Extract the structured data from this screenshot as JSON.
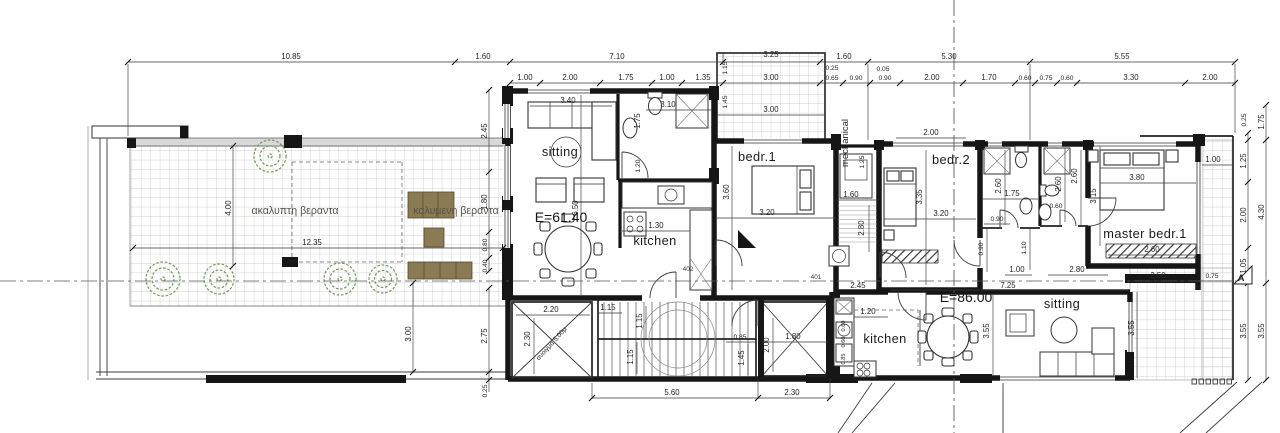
{
  "drawing": {
    "type": "architectural floor plan",
    "apartments": [
      {
        "name": "unit-1",
        "area_label": "E=61.40",
        "rooms": [
          "sitting",
          "kitchen",
          "bedr.1"
        ],
        "room_number": "402"
      },
      {
        "name": "unit-2",
        "area_label": "E=86.00",
        "rooms": [
          "sitting",
          "kitchen",
          "bedr.2",
          "master bedr.1"
        ],
        "room_number": "401"
      }
    ],
    "outdoor": {
      "uncovered_veranda": "ακαλυπτη βεραντα",
      "covered_veranda": "καλυμενη βεραντα"
    },
    "service_spaces": [
      "mechanical"
    ],
    "opening_note": "ανοιγμα 5.00μ",
    "section_marker": "A"
  },
  "colors": {
    "paper": "#ffffff",
    "wall": "#161616",
    "tile_line": "#c4c4c4",
    "tree": "#6d9c50",
    "wood_furniture": "#8b7b54",
    "dim_text": "#262626"
  },
  "plan": {
    "labels": [
      {
        "t": "10.85",
        "x": 291,
        "y": 59,
        "k": "dim"
      },
      {
        "t": "1.60",
        "x": 483,
        "y": 59,
        "k": "dim"
      },
      {
        "t": "7.10",
        "x": 617,
        "y": 59,
        "k": "dim"
      },
      {
        "t": "3.25",
        "x": 771,
        "y": 57,
        "k": "dim"
      },
      {
        "t": "1.60",
        "x": 844,
        "y": 59,
        "k": "dim"
      },
      {
        "t": "5.30",
        "x": 949,
        "y": 59,
        "k": "dim"
      },
      {
        "t": "5.55",
        "x": 1122,
        "y": 59,
        "k": "dim"
      },
      {
        "t": "0.25",
        "x": 832,
        "y": 70,
        "k": "tiny"
      },
      {
        "t": "0.05",
        "x": 883,
        "y": 71,
        "k": "tiny"
      },
      {
        "t": "1.00",
        "x": 525,
        "y": 80,
        "k": "dim"
      },
      {
        "t": "2.00",
        "x": 570,
        "y": 80,
        "k": "dim"
      },
      {
        "t": "1.75",
        "x": 626,
        "y": 80,
        "k": "dim"
      },
      {
        "t": "1.00",
        "x": 667,
        "y": 80,
        "k": "dim"
      },
      {
        "t": "1.35",
        "x": 703,
        "y": 80,
        "k": "dim"
      },
      {
        "t": "3.00",
        "x": 771,
        "y": 80,
        "k": "dim"
      },
      {
        "t": "0.65",
        "x": 832,
        "y": 80,
        "k": "tiny"
      },
      {
        "t": "0.90",
        "x": 856,
        "y": 80,
        "k": "tiny"
      },
      {
        "t": "0.90",
        "x": 885,
        "y": 80,
        "k": "tiny"
      },
      {
        "t": "2.00",
        "x": 932,
        "y": 80,
        "k": "dim"
      },
      {
        "t": "1.70",
        "x": 989,
        "y": 80,
        "k": "dim"
      },
      {
        "t": "0.60",
        "x": 1025,
        "y": 80,
        "k": "tiny"
      },
      {
        "t": "0.75",
        "x": 1046,
        "y": 80,
        "k": "tiny"
      },
      {
        "t": "0.60",
        "x": 1067,
        "y": 80,
        "k": "tiny"
      },
      {
        "t": "3.30",
        "x": 1131,
        "y": 80,
        "k": "dim"
      },
      {
        "t": "2.00",
        "x": 1210,
        "y": 80,
        "k": "dim"
      },
      {
        "t": "0.25",
        "x": 1246,
        "y": 120,
        "r": -90,
        "k": "tiny"
      },
      {
        "t": "1.75",
        "x": 1264,
        "y": 122,
        "r": -90,
        "k": "dim"
      },
      {
        "t": "1.25",
        "x": 1246,
        "y": 161,
        "r": -90,
        "k": "dim"
      },
      {
        "t": "2.00",
        "x": 1246,
        "y": 215,
        "r": -90,
        "k": "dim"
      },
      {
        "t": "4.30",
        "x": 1264,
        "y": 212,
        "r": -90,
        "k": "dim"
      },
      {
        "t": "1.05",
        "x": 1246,
        "y": 266,
        "r": -90,
        "k": "dim"
      },
      {
        "t": "3.55",
        "x": 1246,
        "y": 331,
        "r": -90,
        "k": "dim"
      },
      {
        "t": "3.55",
        "x": 1264,
        "y": 331,
        "r": -90,
        "k": "dim"
      },
      {
        "t": "2.45",
        "x": 487,
        "y": 131,
        "r": -90,
        "k": "dim"
      },
      {
        "t": "1.80",
        "x": 487,
        "y": 202,
        "r": -90,
        "k": "dim"
      },
      {
        "t": "0.80",
        "x": 487,
        "y": 245,
        "r": -90,
        "k": "tiny"
      },
      {
        "t": "0.40",
        "x": 487,
        "y": 266,
        "r": -90,
        "k": "tiny"
      },
      {
        "t": "2.75",
        "x": 487,
        "y": 336,
        "r": -90,
        "k": "dim"
      },
      {
        "t": "0.25",
        "x": 487,
        "y": 391,
        "r": -90,
        "k": "tiny"
      },
      {
        "t": "3.00",
        "x": 411,
        "y": 334,
        "r": -90,
        "k": "dim"
      },
      {
        "t": "4.00",
        "x": 231,
        "y": 208,
        "r": -90,
        "k": "dim"
      },
      {
        "t": "12.35",
        "x": 312,
        "y": 245,
        "k": "dim"
      },
      {
        "t": "5.60",
        "x": 672,
        "y": 395,
        "k": "dim"
      },
      {
        "t": "2.30",
        "x": 792,
        "y": 395,
        "k": "dim"
      },
      {
        "t": "sitting",
        "x": 560,
        "y": 156,
        "k": "room"
      },
      {
        "t": "E=61.40",
        "x": 561,
        "y": 222,
        "k": "area"
      },
      {
        "t": "kitchen",
        "x": 655,
        "y": 245,
        "k": "room"
      },
      {
        "t": "3.40",
        "x": 568,
        "y": 103,
        "k": "dim"
      },
      {
        "t": "3.10",
        "x": 668,
        "y": 107,
        "k": "dim"
      },
      {
        "t": "1.75",
        "x": 640,
        "y": 121,
        "r": -90,
        "k": "dim"
      },
      {
        "t": "1.20",
        "x": 640,
        "y": 166,
        "r": -90,
        "k": "tiny"
      },
      {
        "t": "6.50",
        "x": 578,
        "y": 208,
        "r": -90,
        "k": "dim"
      },
      {
        "t": "1.30",
        "x": 656,
        "y": 228,
        "k": "dim"
      },
      {
        "t": "402",
        "x": 688,
        "y": 271,
        "k": "num"
      },
      {
        "t": "bedr.1",
        "x": 757,
        "y": 161,
        "k": "room"
      },
      {
        "t": "3.60",
        "x": 729,
        "y": 192,
        "r": -90,
        "k": "dim"
      },
      {
        "t": "3.20",
        "x": 767,
        "y": 215,
        "k": "dim"
      },
      {
        "t": "3.00",
        "x": 771,
        "y": 112,
        "k": "dim"
      },
      {
        "t": "1.15",
        "x": 727,
        "y": 68,
        "r": -90,
        "k": "tiny"
      },
      {
        "t": "1.45",
        "x": 727,
        "y": 102,
        "r": -90,
        "k": "tiny"
      },
      {
        "t": "mechanical",
        "x": 848,
        "y": 143,
        "r": -90,
        "k": "roomv"
      },
      {
        "t": "1.25",
        "x": 864,
        "y": 162,
        "r": -90,
        "k": "tiny"
      },
      {
        "t": "1.60",
        "x": 851,
        "y": 197,
        "k": "dim"
      },
      {
        "t": "2.80",
        "x": 864,
        "y": 228,
        "r": -90,
        "k": "dim"
      },
      {
        "t": "401",
        "x": 816,
        "y": 279,
        "k": "num"
      },
      {
        "t": "2.45",
        "x": 858,
        "y": 288,
        "k": "dim"
      },
      {
        "t": "bedr.2",
        "x": 951,
        "y": 164,
        "k": "room"
      },
      {
        "t": "2.00",
        "x": 931,
        "y": 135,
        "k": "dim"
      },
      {
        "t": "3.35",
        "x": 922,
        "y": 197,
        "r": -90,
        "k": "dim"
      },
      {
        "t": "3.20",
        "x": 941,
        "y": 216,
        "k": "dim"
      },
      {
        "t": "2.60",
        "x": 1001,
        "y": 186,
        "r": -90,
        "k": "dim"
      },
      {
        "t": "1.75",
        "x": 1012,
        "y": 196,
        "k": "dim"
      },
      {
        "t": "2.60",
        "x": 1061,
        "y": 184,
        "r": -90,
        "k": "dim"
      },
      {
        "t": "0.60",
        "x": 1056,
        "y": 208,
        "k": "tiny"
      },
      {
        "t": "0.90",
        "x": 997,
        "y": 221,
        "k": "tiny"
      },
      {
        "t": "0.90",
        "x": 983,
        "y": 249,
        "r": -90,
        "k": "tiny"
      },
      {
        "t": "1.10",
        "x": 1026,
        "y": 248,
        "r": -90,
        "k": "tiny"
      },
      {
        "t": "1.00",
        "x": 1017,
        "y": 272,
        "k": "dim"
      },
      {
        "t": "2.80",
        "x": 1077,
        "y": 272,
        "k": "dim"
      },
      {
        "t": "master  bedr.1",
        "x": 1145,
        "y": 238,
        "k": "room"
      },
      {
        "t": "2.60",
        "x": 1077,
        "y": 176,
        "r": -90,
        "k": "dim"
      },
      {
        "t": "3.15",
        "x": 1096,
        "y": 196,
        "r": -90,
        "k": "dim"
      },
      {
        "t": "3.80",
        "x": 1137,
        "y": 180,
        "k": "dim"
      },
      {
        "t": "2.60",
        "x": 1152,
        "y": 252,
        "k": "dim"
      },
      {
        "t": "1.00",
        "x": 1213,
        "y": 162,
        "k": "dim"
      },
      {
        "t": "2.50",
        "x": 1158,
        "y": 278,
        "k": "dim"
      },
      {
        "t": "0.75",
        "x": 1212,
        "y": 278,
        "k": "tiny"
      },
      {
        "t": "2.20",
        "x": 551,
        "y": 312,
        "k": "dim"
      },
      {
        "t": "2.30",
        "x": 530,
        "y": 339,
        "r": -90,
        "k": "dim"
      },
      {
        "t": "ανοιγμα 5.00μ",
        "x": 553,
        "y": 345,
        "r": -48,
        "k": "tiny"
      },
      {
        "t": "1.15",
        "x": 608,
        "y": 310,
        "k": "dim"
      },
      {
        "t": "1.15",
        "x": 642,
        "y": 321,
        "r": -90,
        "k": "dim"
      },
      {
        "t": "1.15",
        "x": 633,
        "y": 357,
        "r": -90,
        "k": "dim"
      },
      {
        "t": "0.85",
        "x": 740,
        "y": 339,
        "k": "tiny"
      },
      {
        "t": "1.45",
        "x": 744,
        "y": 358,
        "r": -90,
        "k": "dim"
      },
      {
        "t": "2.00",
        "x": 769,
        "y": 345,
        "r": -90,
        "k": "dim"
      },
      {
        "t": "1.80",
        "x": 793,
        "y": 339,
        "k": "dim"
      },
      {
        "t": "E=86.00",
        "x": 966,
        "y": 302,
        "k": "area"
      },
      {
        "t": "kitchen",
        "x": 885,
        "y": 343,
        "k": "room"
      },
      {
        "t": "sitting",
        "x": 1062,
        "y": 308,
        "k": "room"
      },
      {
        "t": "1.20",
        "x": 868,
        "y": 314,
        "k": "dim"
      },
      {
        "t": "0.60",
        "x": 845,
        "y": 326,
        "r": -90,
        "k": "micro"
      },
      {
        "t": "0.60",
        "x": 845,
        "y": 342,
        "r": -90,
        "k": "micro"
      },
      {
        "t": "0.85",
        "x": 845,
        "y": 359,
        "r": -90,
        "k": "micro"
      },
      {
        "t": "7.25",
        "x": 1008,
        "y": 288,
        "k": "dim"
      },
      {
        "t": "3.55",
        "x": 989,
        "y": 331,
        "r": -90,
        "k": "dim"
      },
      {
        "t": "3.55",
        "x": 1134,
        "y": 328,
        "r": -90,
        "k": "dim"
      },
      {
        "t": "ακαλυπτη βεραντα",
        "x": 295,
        "y": 214,
        "k": "greek"
      },
      {
        "t": "καλυμενη βεραντα",
        "x": 456,
        "y": 214,
        "k": "greek"
      },
      {
        "t": "A",
        "x": 1241,
        "y": 281,
        "k": "marker"
      }
    ]
  }
}
